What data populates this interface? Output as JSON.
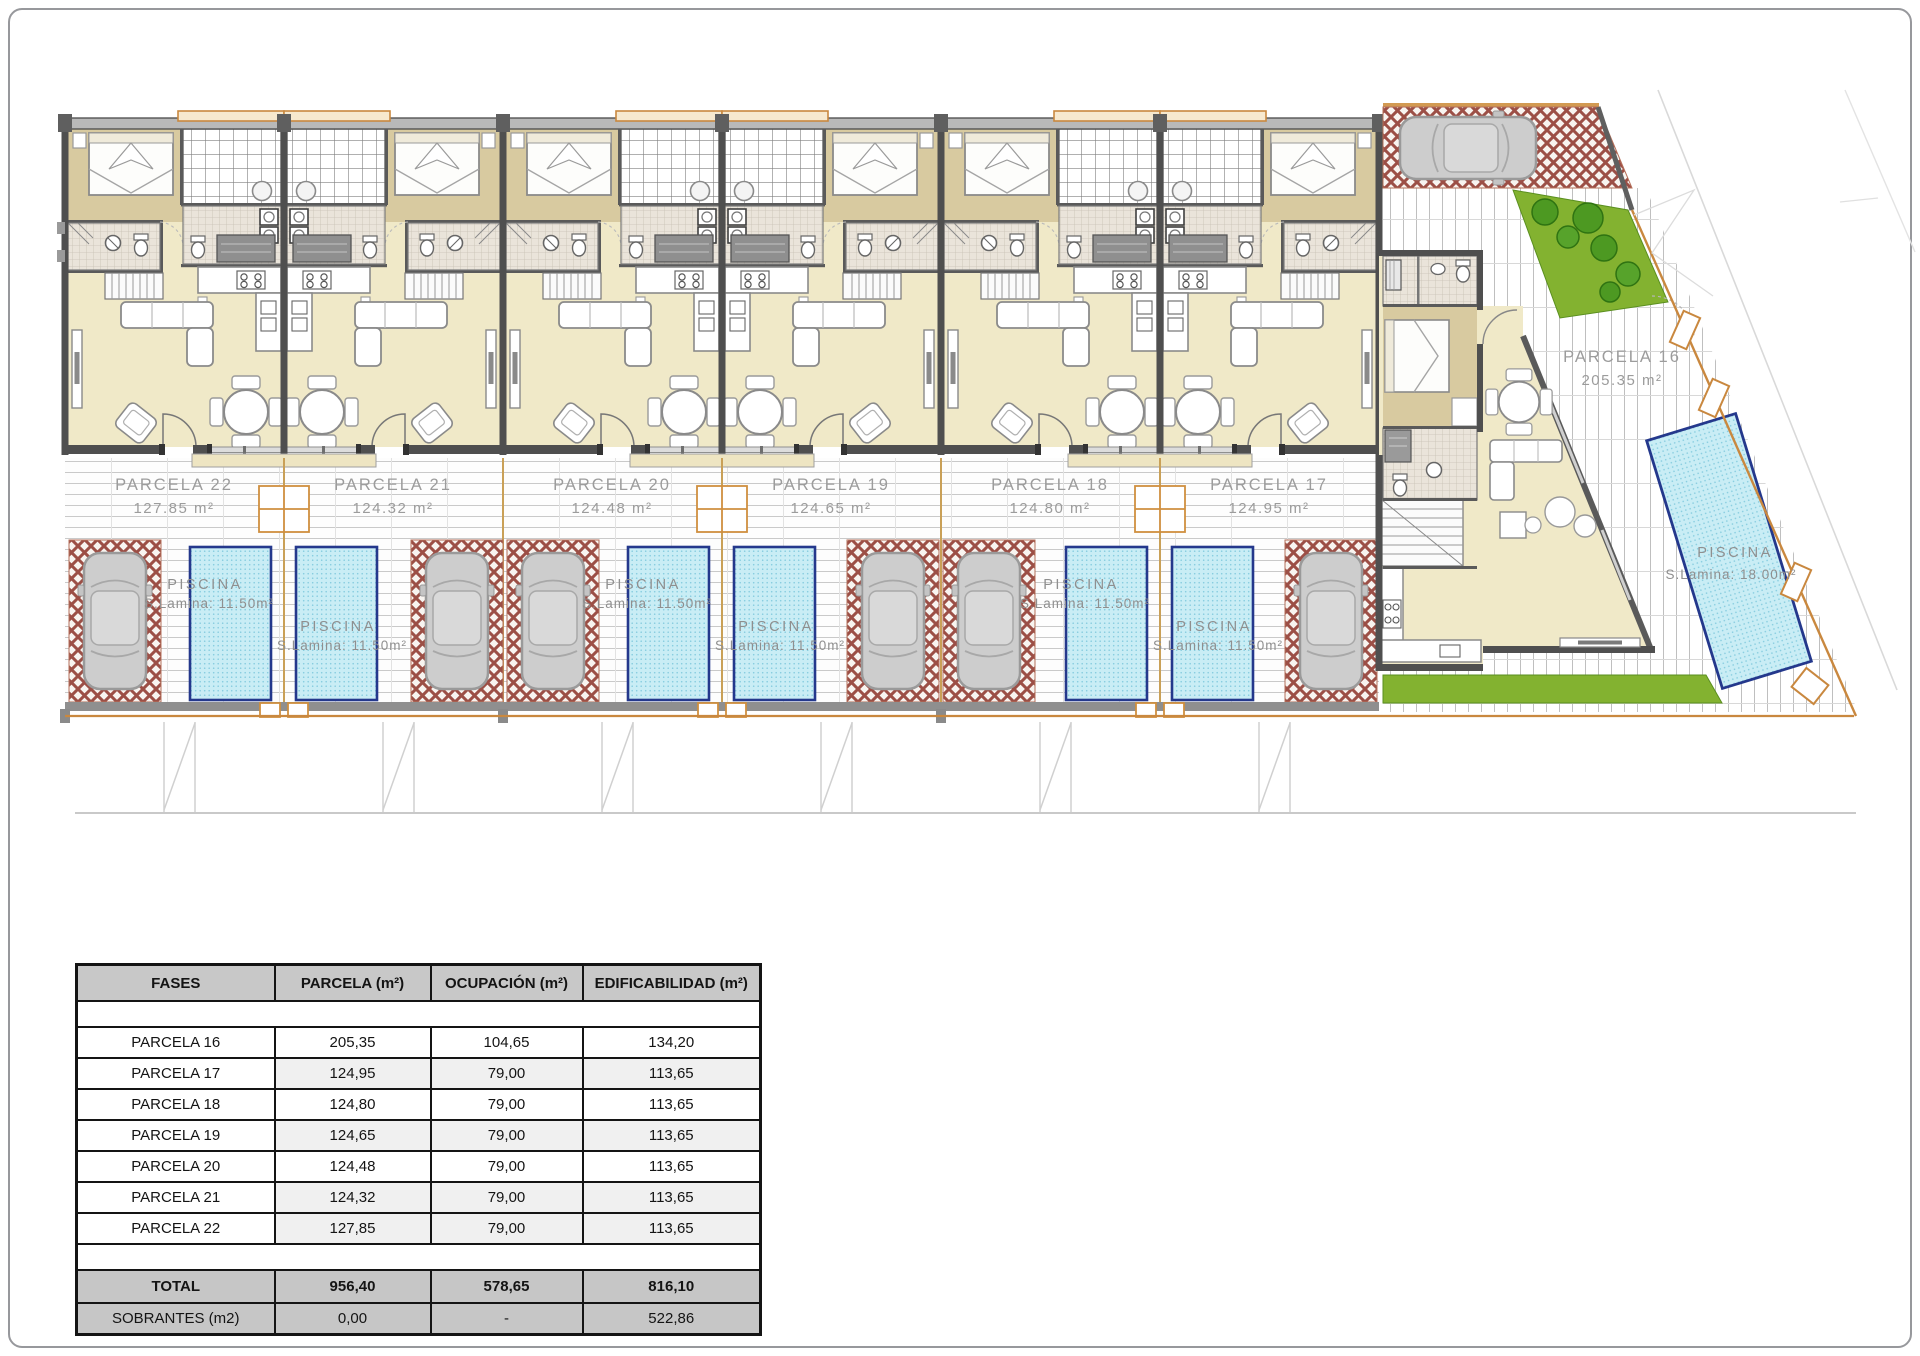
{
  "plan": {
    "parcels": [
      {
        "name": "PARCELA 22",
        "area": "127.85 m²"
      },
      {
        "name": "PARCELA 21",
        "area": "124.32 m²"
      },
      {
        "name": "PARCELA 20",
        "area": "124.48 m²"
      },
      {
        "name": "PARCELA 19",
        "area": "124.65 m²"
      },
      {
        "name": "PARCELA 18",
        "area": "124.80 m²"
      },
      {
        "name": "PARCELA 17",
        "area": "124.95 m²"
      }
    ],
    "parcel16": {
      "name": "PARCELA 16",
      "area": "205.35 m²"
    },
    "pool_label": {
      "title": "PISCINA",
      "detail": "S.Lamina: 11.50m²"
    },
    "pool16_label": {
      "title": "PISCINA",
      "detail": "S.Lamina: 18.00m²"
    }
  },
  "table": {
    "headers": [
      "FASES",
      "PARCELA (m²)",
      "OCUPACIÓN (m²)",
      "EDIFICABILIDAD (m²)"
    ],
    "rows": [
      [
        "PARCELA 16",
        "205,35",
        "104,65",
        "134,20"
      ],
      [
        "PARCELA 17",
        "124,95",
        "79,00",
        "113,65"
      ],
      [
        "PARCELA 18",
        "124,80",
        "79,00",
        "113,65"
      ],
      [
        "PARCELA 19",
        "124,65",
        "79,00",
        "113,65"
      ],
      [
        "PARCELA 20",
        "124,48",
        "79,00",
        "113,65"
      ],
      [
        "PARCELA 21",
        "124,32",
        "79,00",
        "113,65"
      ],
      [
        "PARCELA 22",
        "127,85",
        "79,00",
        "113,65"
      ]
    ],
    "total": [
      "TOTAL",
      "956,40",
      "578,65",
      "816,10"
    ],
    "sobrantes": [
      "SOBRANTES (m2)",
      "0,00",
      "-",
      "522,86"
    ]
  },
  "colors": {
    "pool_fill": "#c9edf5",
    "pool_border": "#24388c",
    "paver_red": "#9c4f46",
    "grass": "#83b230",
    "fence_orange": "#c9883f",
    "wall_gray": "#4f4f4f",
    "label_gray": "#9c9c9c"
  }
}
